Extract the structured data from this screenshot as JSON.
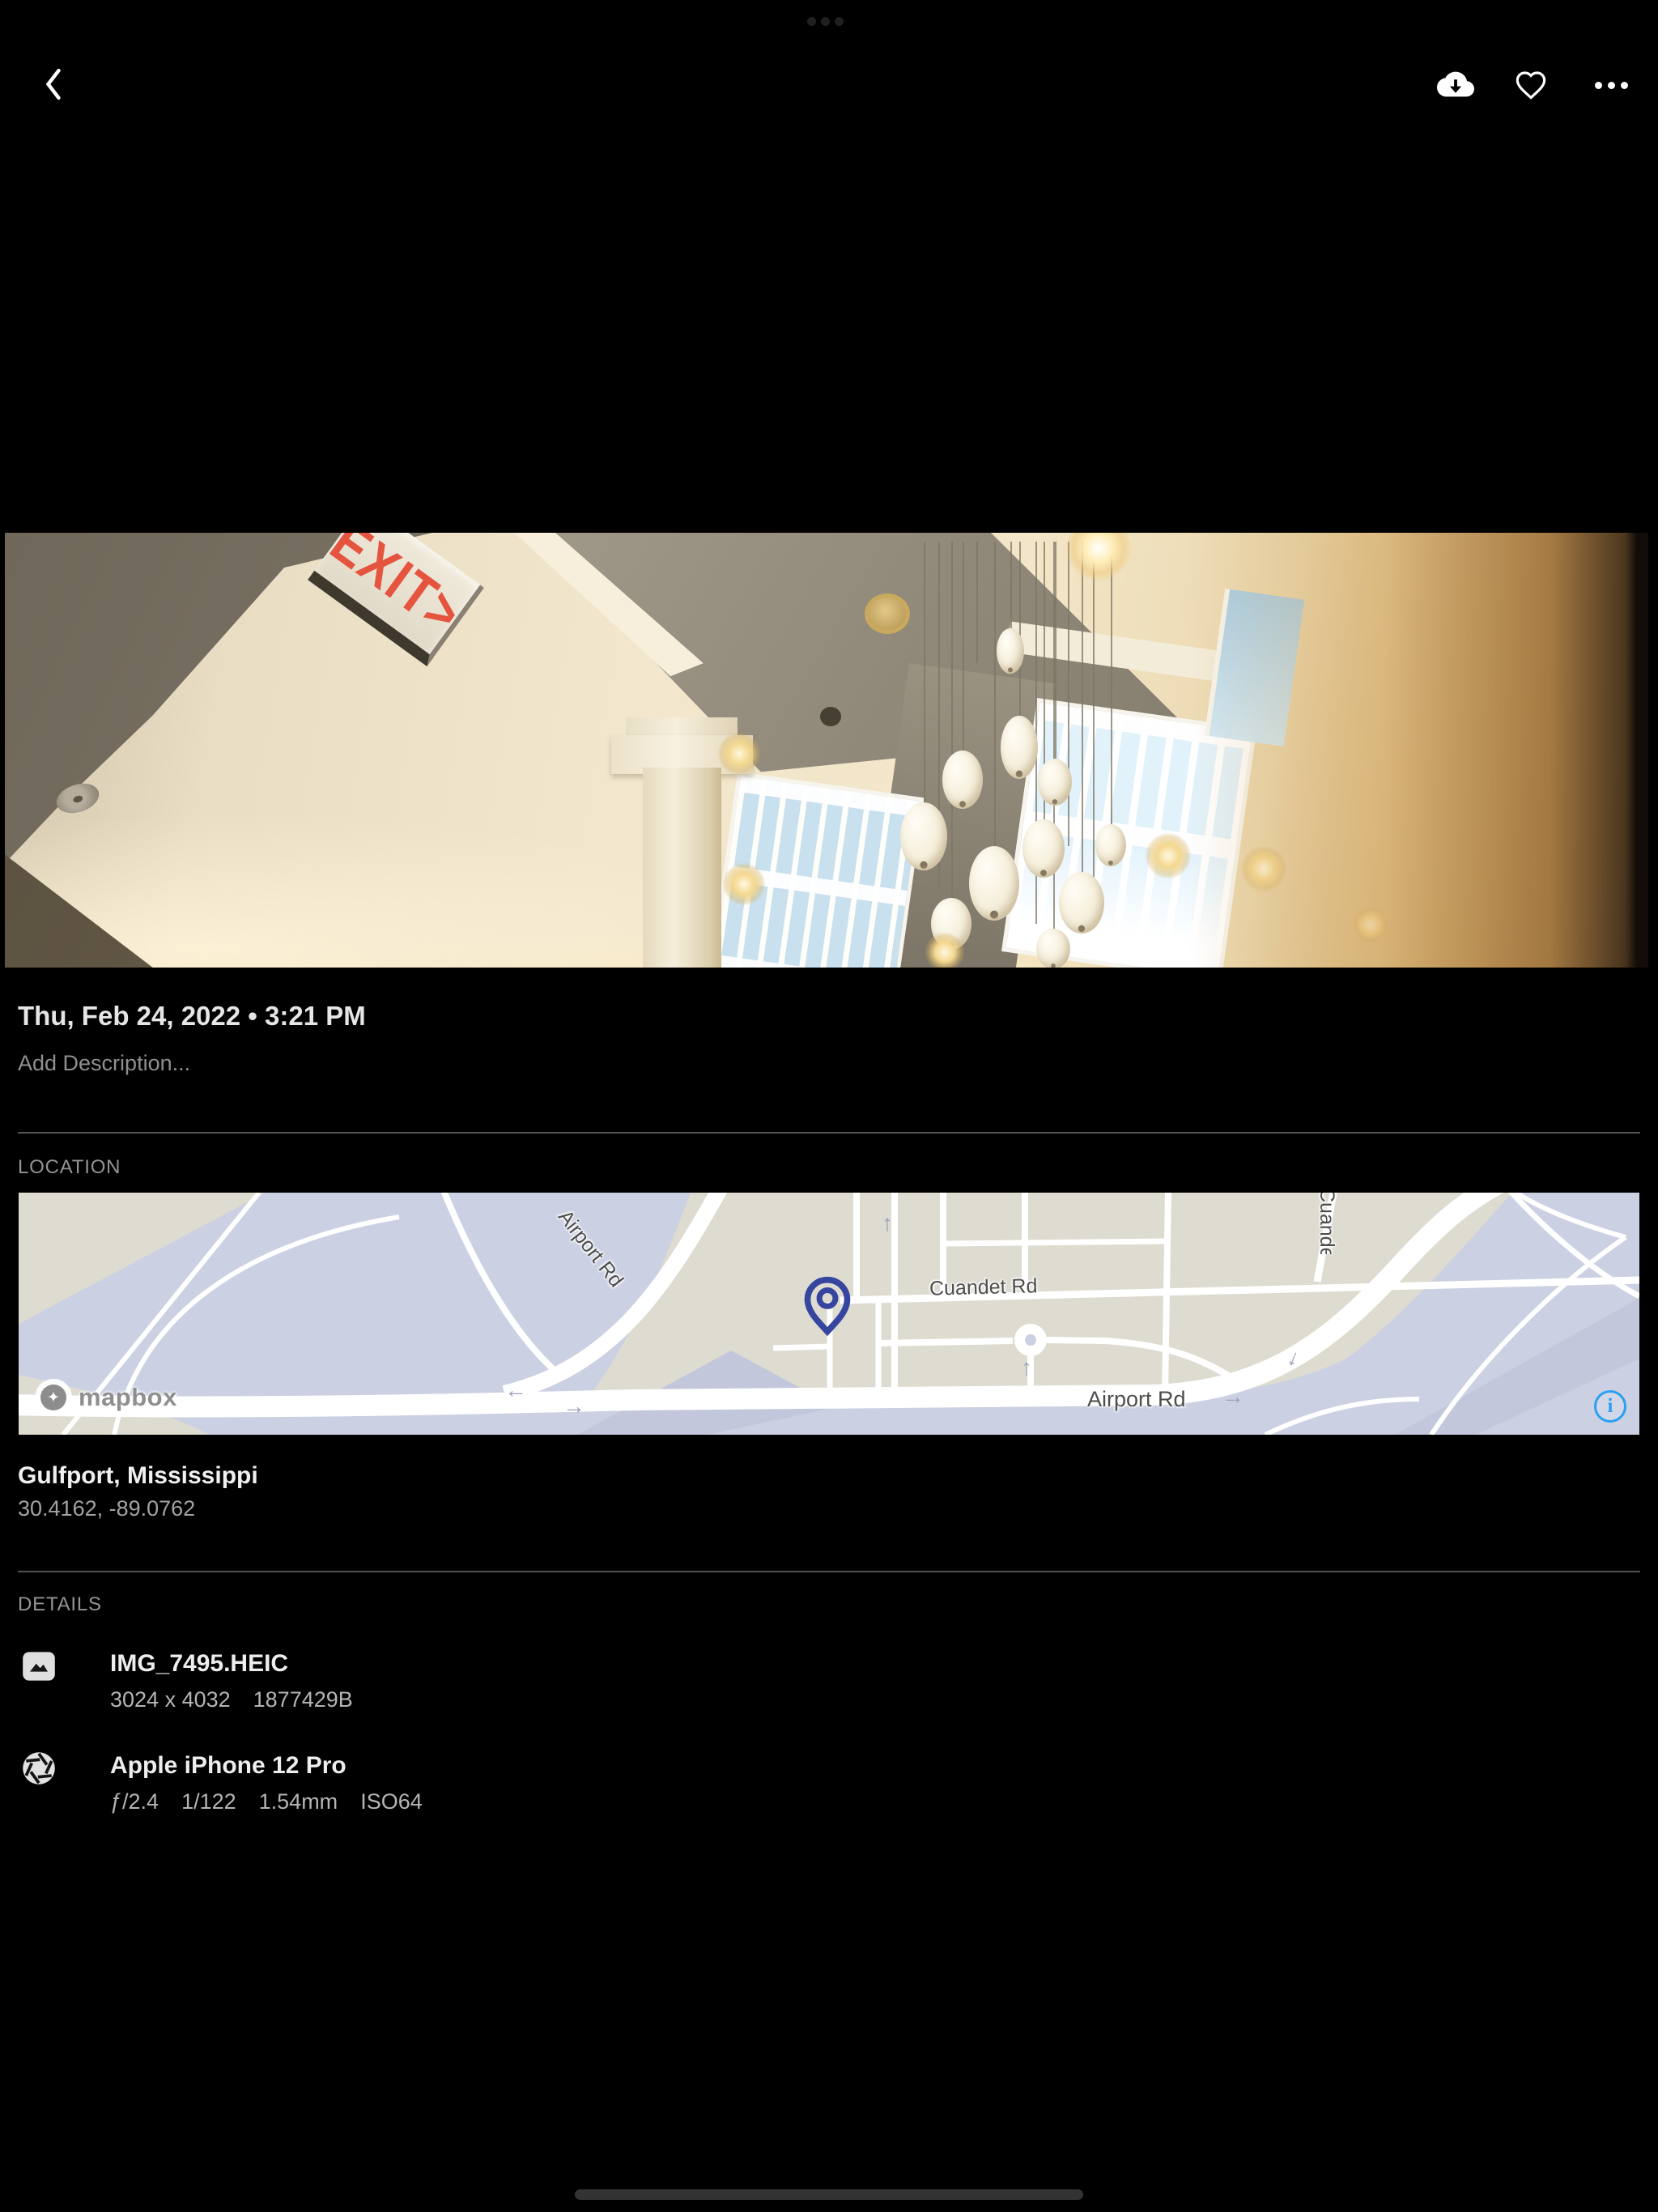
{
  "top_bar": {
    "back_icon": "chevron-left",
    "download_icon": "cloud-download",
    "favorite_icon": "heart-outline",
    "more_icon": "ellipsis"
  },
  "photo": {
    "exit_sign_text": "EXIT>"
  },
  "metadata": {
    "datetime": "Thu, Feb 24, 2022 • 3:21 PM",
    "description_placeholder": "Add Description..."
  },
  "location": {
    "section_label": "LOCATION",
    "place": "Gulfport, Mississippi",
    "coordinates": "30.4162, -89.0762",
    "map": {
      "attribution": "mapbox",
      "road_labels": {
        "airport_diag": "Airport Rd",
        "cuandet": "Cuandet Rd",
        "airport_horiz": "Airport Rd",
        "airport_clipped": "Airport Rd",
        "cuandet_clipped": "Cuandet Rd"
      },
      "arrows": [
        "←",
        "→",
        "↑",
        "→",
        "↑",
        "↓"
      ],
      "info_icon_label": "i",
      "colors": {
        "water": "#cbd0e3",
        "land": "#dedbd1",
        "pin": "#36459e",
        "info_blue": "#2aa0f2"
      }
    }
  },
  "details": {
    "section_label": "DETAILS",
    "file": {
      "name": "IMG_7495.HEIC",
      "dimensions": "3024 x 4032",
      "size": "1877429B"
    },
    "camera": {
      "name": "Apple iPhone 12 Pro",
      "aperture": "ƒ/2.4",
      "shutter_speed": "1/122",
      "focal_length": "1.54mm",
      "iso": "ISO64"
    }
  }
}
